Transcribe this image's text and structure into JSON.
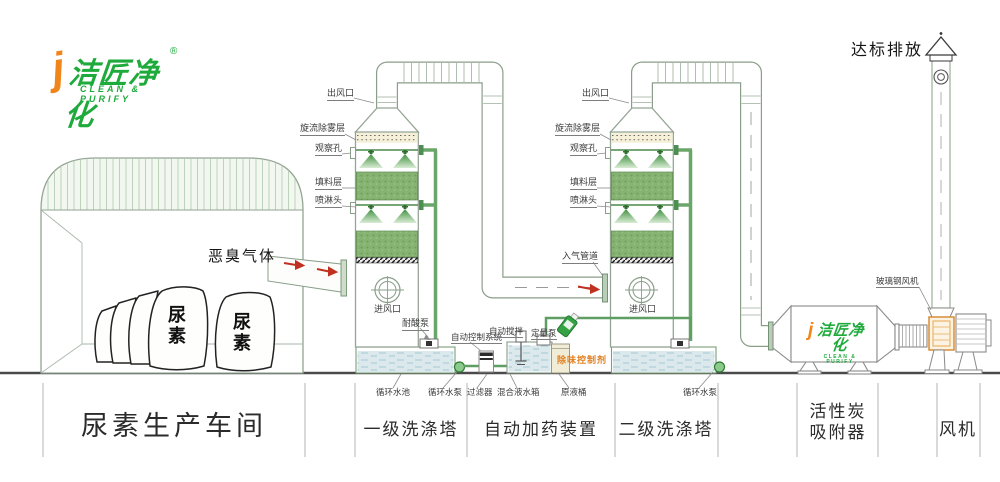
{
  "logo": {
    "monogram": "j",
    "brand": "洁匠净化",
    "registered": "®",
    "tagline": "CLEAN & PURIFY"
  },
  "workshop": {
    "gas_label": "恶臭气体",
    "bag_label": "尿素"
  },
  "tower1": {
    "outlet_label": "出风口",
    "demister_label": "旋流除雾层",
    "viewport_label": "观察孔",
    "packing_label": "填料层",
    "spray_label": "喷淋头",
    "inlet_label": "进风口",
    "acid_pump_label": "耐酸泵",
    "pool_label": "循环水池",
    "pump_label": "循环水泵"
  },
  "tower2": {
    "outlet_label": "出风口",
    "demister_label": "旋流除雾层",
    "viewport_label": "观察孔",
    "packing_label": "填料层",
    "spray_label": "喷淋头",
    "inlet_label": "进风口",
    "inlet_pipe_label": "入气管道",
    "pump_label": "循环水泵"
  },
  "dosing": {
    "control_label": "自动控制系统",
    "stirrer_label": "自动搅拌",
    "metering_label": "定量泵",
    "agent_label": "除味控制剂",
    "filter_label": "过滤器",
    "mix_tank_label": "混合液水箱",
    "barrel_label": "原液桶"
  },
  "adsorber": {
    "brand": "洁匠净化",
    "tagline": "CLEAN & PURIFY",
    "monogram": "j"
  },
  "exhaust": {
    "emission_label": "达标排放",
    "fan_label": "玻璃钢风机"
  },
  "sections": {
    "workshop": "尿素生产车间",
    "tower1": "一级洗涤塔",
    "dosing": "自动加药装置",
    "tower2": "二级洗涤塔",
    "adsorber_line1": "活性炭",
    "adsorber_line2": "吸附器",
    "fan": "风机"
  },
  "colors": {
    "brand_green": "#1faa3c",
    "brand_orange": "#f08519",
    "packing_green": "#86b272",
    "agent_orange": "#e07f1f",
    "arrow_red": "#c03122",
    "water_blue": "#dbe9ed",
    "demister_cream": "#f6f0d8",
    "line_green": "#8a9e8a"
  }
}
